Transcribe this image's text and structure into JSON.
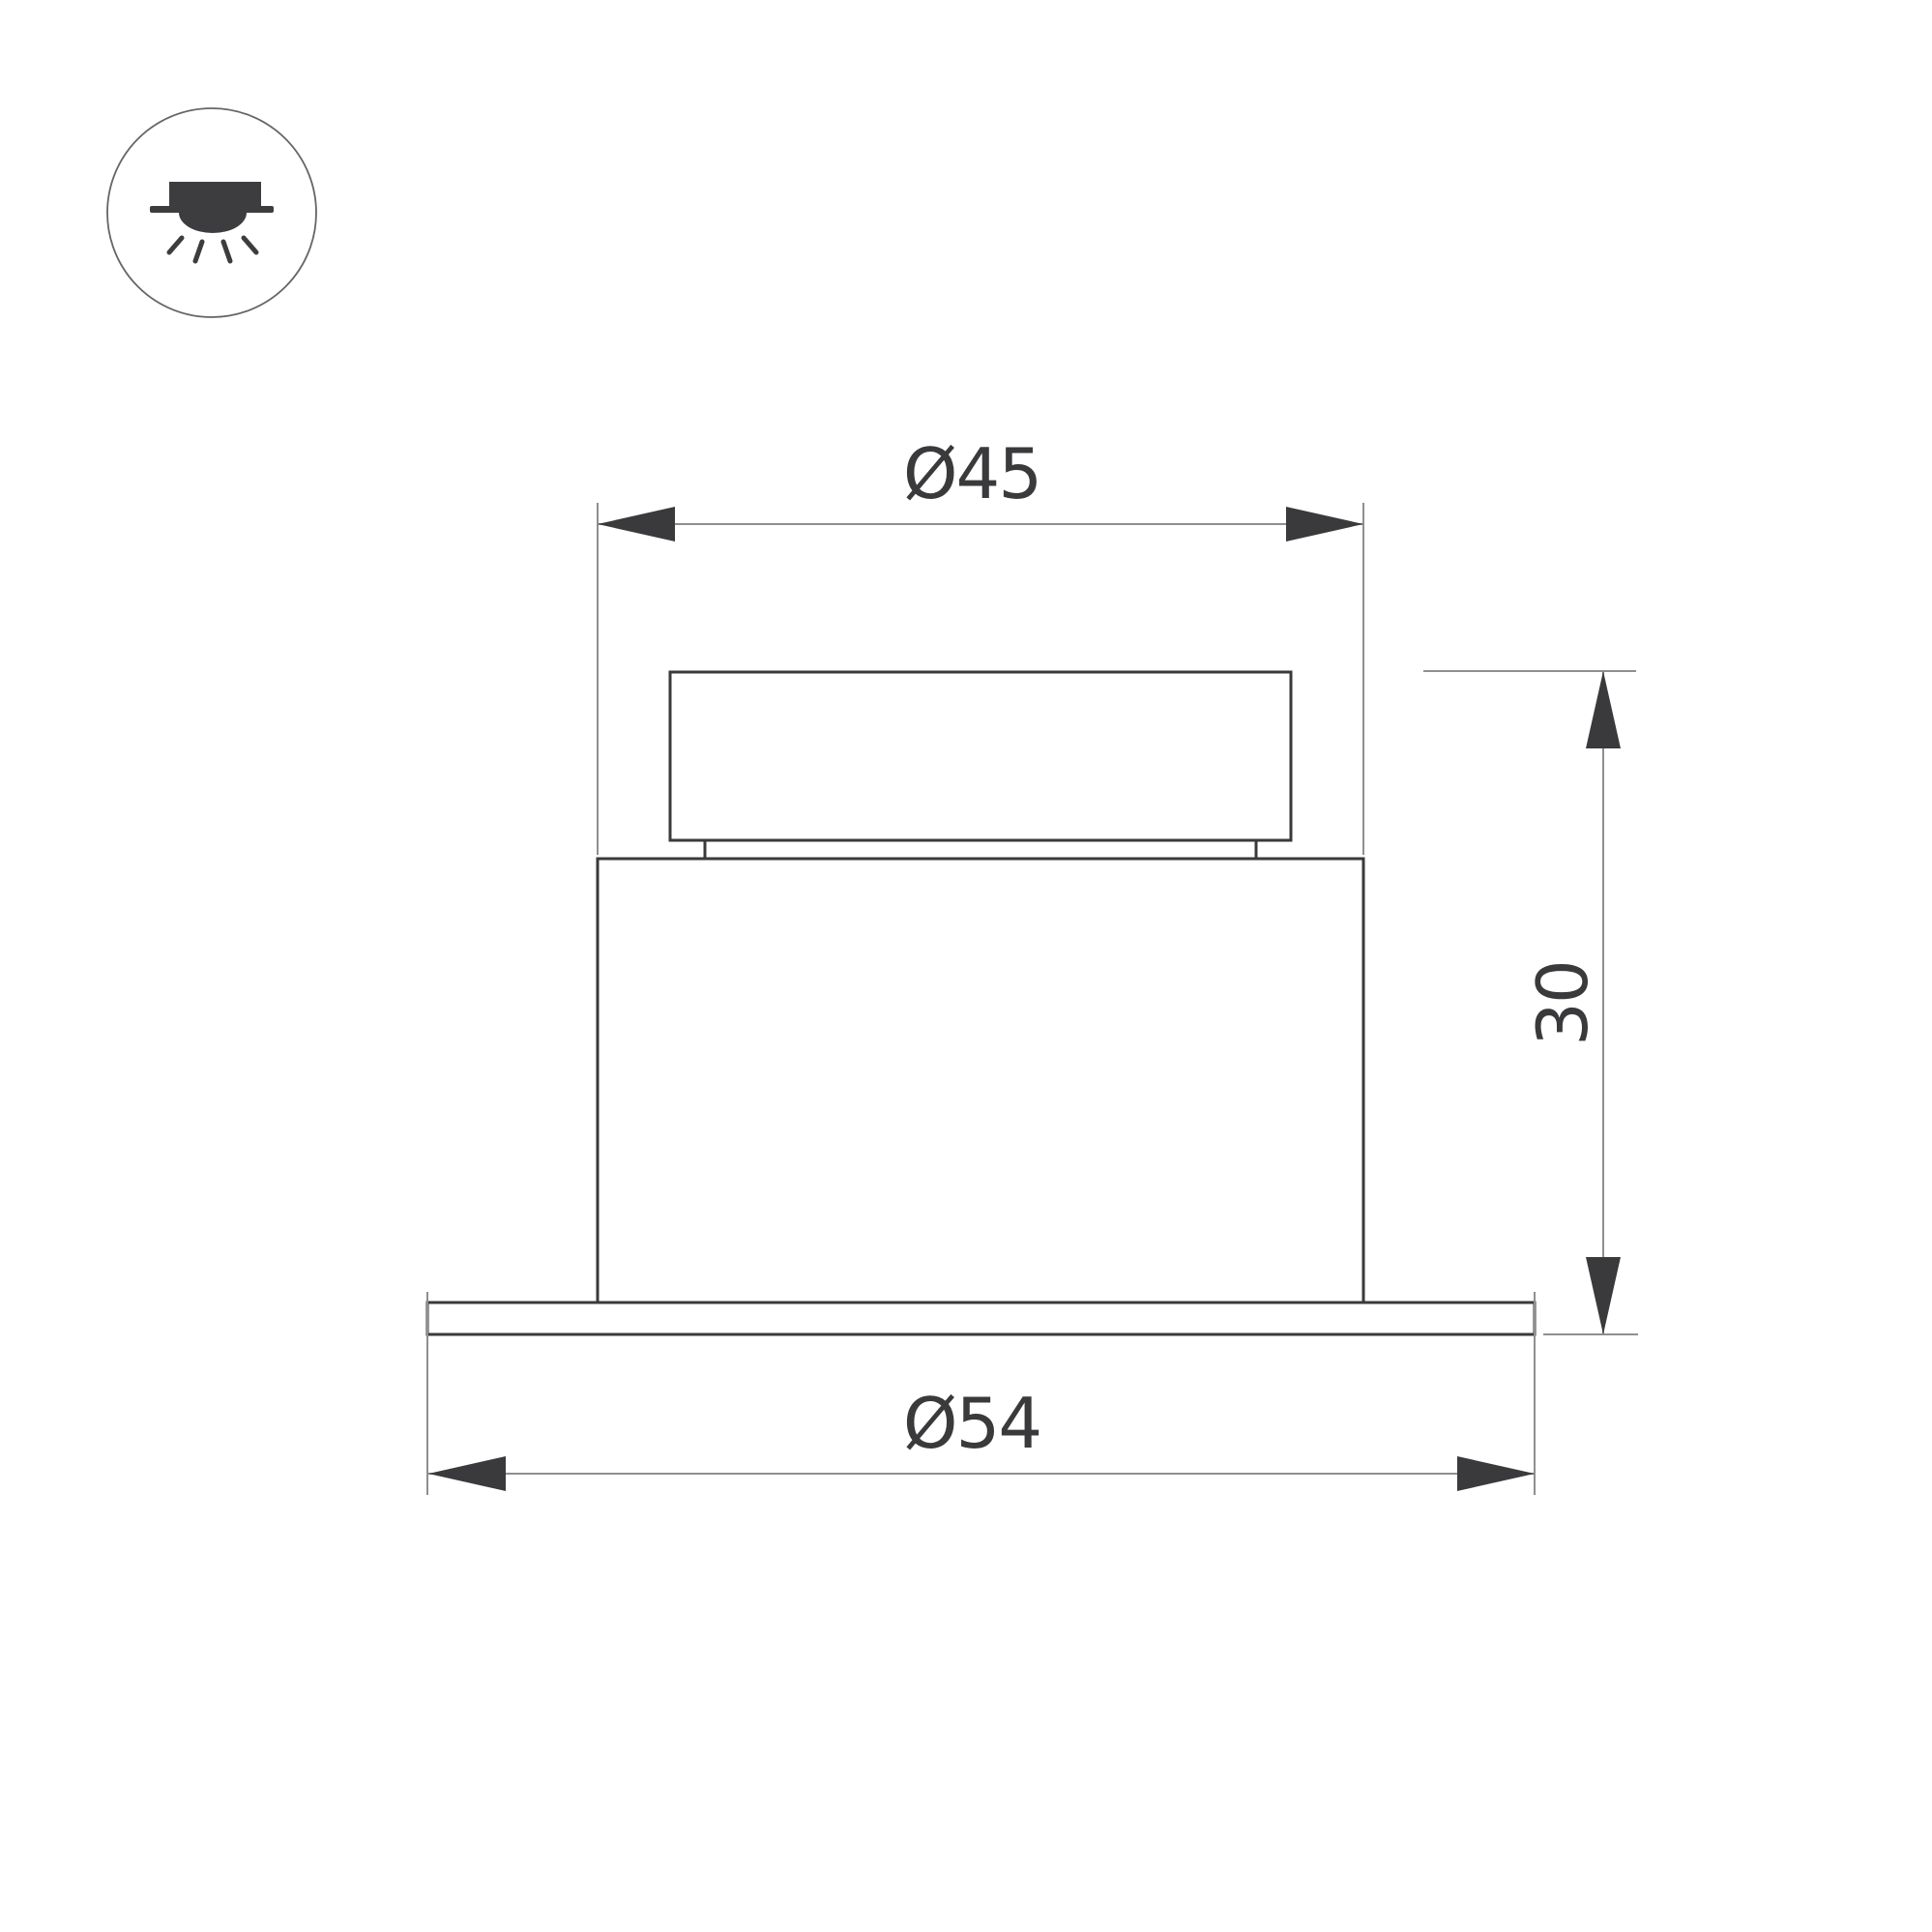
{
  "colors": {
    "background": "#ffffff",
    "outline": "#3a3a3c",
    "dim_line": "#8f8f8f",
    "label_text": "#3a3a3c",
    "icon_fill": "#3d3d3f",
    "icon_ring": "#666666"
  },
  "legend": {
    "mount_type_icon": "recessed-downlight-icon"
  },
  "drawing": {
    "type": "dimensioned technical drawing of recessed luminaire, front view",
    "dimensions": {
      "body_diameter": {
        "label": "Ø45"
      },
      "flange_diameter": {
        "label": "Ø54"
      },
      "height": {
        "label": "30"
      }
    }
  }
}
